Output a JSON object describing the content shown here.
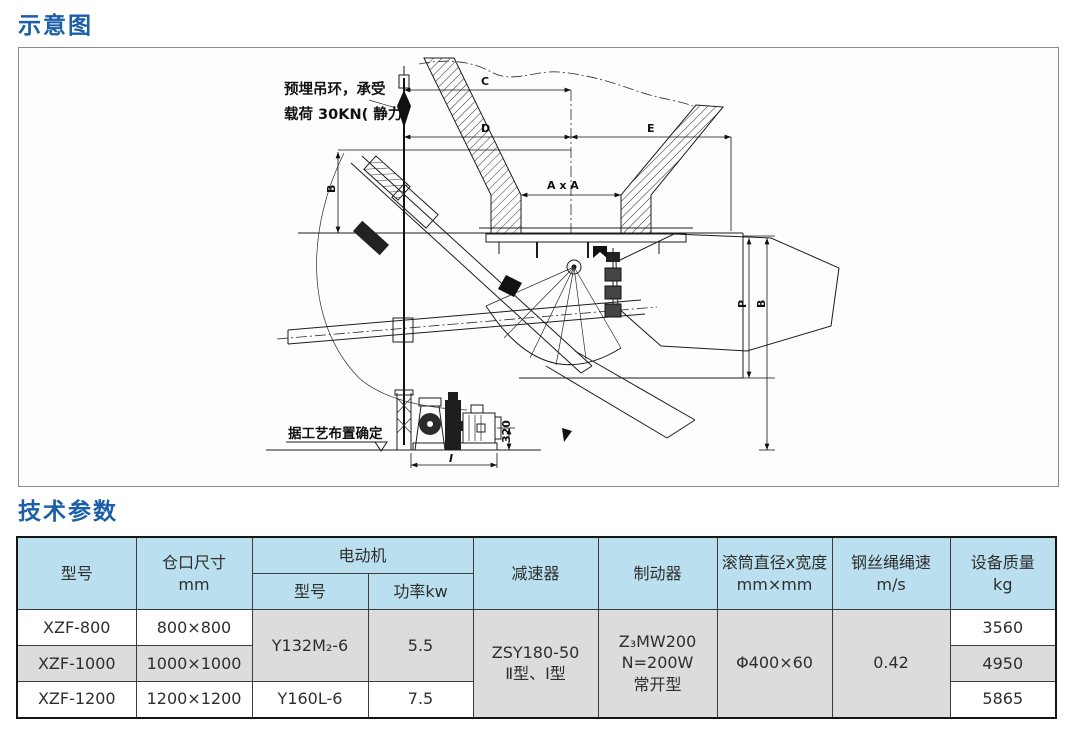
{
  "page": {
    "section1_title": "示意图",
    "section2_title": "技术参数"
  },
  "diagram": {
    "annotation_top_line1": "预埋吊环，承受",
    "annotation_top_line2": "载荷 30KN( 静力)",
    "annotation_bottom": "据工艺布置确定",
    "dims": {
      "c": "C",
      "d": "D",
      "e": "E",
      "axa": "A x A",
      "b_left": "B",
      "p": "P",
      "b_right": "B",
      "h320": "320",
      "i": "I"
    }
  },
  "table": {
    "header": {
      "model": "型号",
      "opening_size": "仓口尺寸\nmm",
      "motor": "电动机",
      "motor_model": "型号",
      "motor_power": "功率kw",
      "reducer": "减速器",
      "brake": "制动器",
      "drum": "滚筒直径x宽度\nmm×mm",
      "rope_speed": "钢丝绳绳速\nm/s",
      "mass": "设备质量\nkg"
    },
    "rows": [
      {
        "model": "XZF-800",
        "opening": "800×800",
        "mass": "3560"
      },
      {
        "model": "XZF-1000",
        "opening": "1000×1000",
        "mass": "4950"
      },
      {
        "model": "XZF-1200",
        "opening": "1200×1200",
        "mass": "5865"
      }
    ],
    "merged": {
      "motor_model_r12": "Y132M₂-6",
      "motor_power_r12": "5.5",
      "motor_model_r3": "Y160L-6",
      "motor_power_r3": "7.5",
      "reducer_all": "ZSY180-50\nⅡ型、Ⅰ型",
      "brake_all": "Z₃MW200\nN=200W\n常开型",
      "drum_all": "Φ400×60",
      "rope_speed_all": "0.42"
    }
  },
  "colors": {
    "title_blue": "#1b5ea8",
    "header_bg": "#bae0f0",
    "row_gray": "#dcdcdc",
    "row_white": "#ffffff"
  }
}
